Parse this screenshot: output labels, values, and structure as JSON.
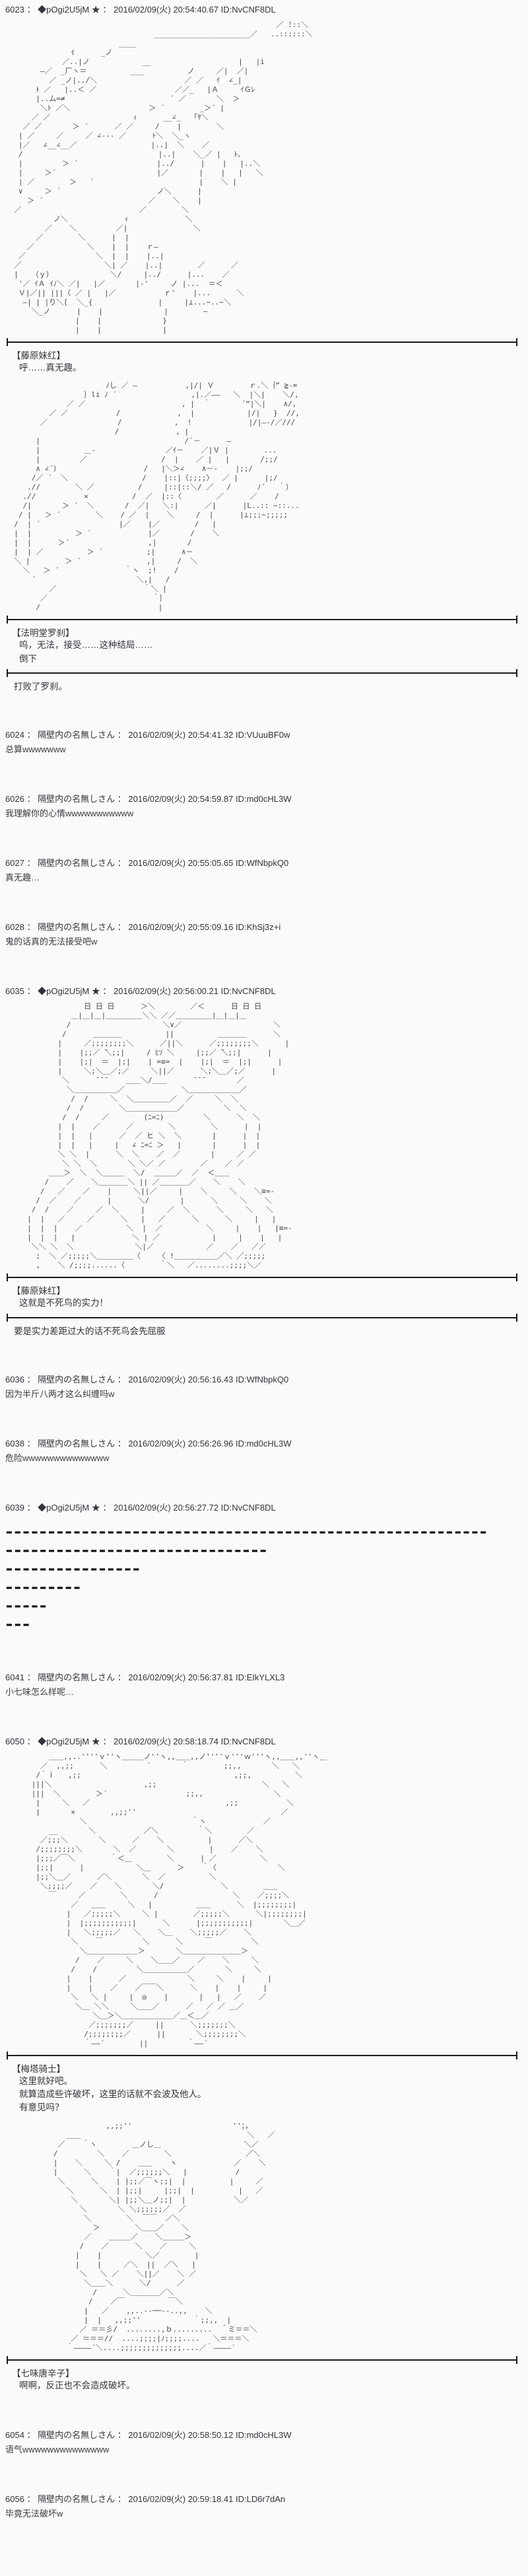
{
  "page": {
    "background": "#fafafa",
    "text_color": "#3a3a42",
    "divider_color": "#1a1a1a"
  },
  "posts": [
    {
      "header": "6023 ： ◆pOgi2U5jM ★ ： 2016/02/09(火) 20:54:40.67 ID:NvCNF8DL",
      "aa1": [
        "                                                              ／ ̄:::＼",
        "                                  ______________________／   ..::::::＼",
        "                          ____",
        "               ｲ      _ノ",
        "             ／..|ノ            __                    |   |i",
        "        ―／  _厂ヽ＝          ___          ノ     ／|  ／|",
        "          ／ _ノ|../＼                    ／ ／   ｲ  ∠_|",
        "       ﾄ ／   |..＜ ／                  ／／_   |Ａ     ｲＧﾚ",
        "       |..ム=≠                        ´ ／       ＼  ＞",
        "        ＼ﾄ ／＼                  ＞ ´        _＞´ |",
        "      ／ ／                   ｨ      __∠_   ｢ﾔ＼",
        "    ／ ／       ＞ ´      ／ ／     /    |        ＼",
        "   | ／     ／     ／ ∠--- ／      ﾄ＼  ＼_ヽ",
        "   |／   ∠__∠__／                 |..|  ＼    ／",
        "   /                               |..|    ＼_／ |   ﾄ、",
        "   |         ＞ ´                  |../      |    |   |..＼",
        "   |     ＞´                       |／       |    |   |   ＼",
        "   | ／        ＞   ´                        |    ＼ |",
        "   ∨     ＞ ´                      ノ＼      |",
        "     ＞ ´                        ／    ＼    |",
        "  ／                           ／        ＼",
        "           ノ＼             ｨ             ＼",
        "         ／    ＼         ／|               ＼",
        "       ／        ＼      |  |",
        "     ／            ＼    |  |    ｒ―",
        "   ／                ＼  |  |    |..|",
        "  ／                   ＼| ／    |..|        ／      ／",
        "  |   （ｙ）             ＼/     |../      |...    ／",
        "   '／ ｲＡ ｲﾉ＼ ／|   |／       |-'     ノ |...  ＝＜",
        "   Ｖ|／|| |||〈 ／ |   |／           ｒ'    |...      ＼",
        "    ―| | |り＼[  ＼_{               |     |⊥...~..~＼",
        "      ＼_ノ      |    |              |        ~",
        "                |    |              }",
        "                |    |              |"
      ],
      "speech1": {
        "speaker": "【藤原妹红】",
        "lines": [
          "呼……真无趣。"
        ]
      },
      "aa2": [
        "                       ﾉし ／ ―           ,|/| Ｖ        ｒ.＼｛” ≧-=",
        "                  ｝li ﾉ ´                 ,|.／――   ＼  |＼|    ＼/,",
        "              ／ ／                      , |  ｀       ´”|＼|    ∧/,",
        "          ／ ／           /             ,  |            |/|   }  //,",
        "        ／                /            ,  !             |/|―-/／///",
        "                         /             , |",
        "       |                                 /´－      ―",
        "       |          ＿-                ／ｲ－    ／|Ｖ |        ...",
        "       |         ／                 /  |    ／ |   |       /;;/",
        "       ∧ ∠´）                   /   |＼＞∠    ∧－-    |;;/",
        "      /／ ´  ＼                 /    |::|〈;;;;〉  ／ |      |;/",
        "     .//        ＼ ／          /     |::|::＼/ ／   /      ﾉ´   ｀）",
        "    .//           ×          /  ／  |::〈        ／      ／    /",
        "    /|       ＞ ´  ＼       /  ／|   ＼:|      ／|      |L..:: ~::...",
        "   / |   ＞ ´        ＼    / ／  |    ＼     /  |      |⊥;;;~;;;;;",
        "  /  | ´                  |／    |／        /   |",
        "  |  |          ＞ ´             |／       /    ＼",
        "  |  |      ＞´                  ,|       /",
        "  |  | ／          ＞ ´          ;|      ∧－",
        "  ＼ |        ＞ ´               ,|     /  ＼",
        "    ＼   ＞ ´               ｀ヽ  ;!    /",
        "      ´                       ＼,|   /",
        "          ／                    ｀＼ |",
        "        ／                        ｀｝",
        "       /                           |"
      ],
      "speech2": {
        "speaker": "【法明堂罗刹】",
        "lines": [
          "呜，无法，接受……这种结局……",
          "倒下"
        ]
      },
      "narration": "打败了罗刹。"
    },
    {
      "header": "6024 ： 隔壁内の名無しさん ： 2016/02/09(火) 20:54:41.32 ID:VUuuBF0w",
      "body": "总算wwwwwww"
    },
    {
      "header": "6026 ： 隔壁内の名無しさん ： 2016/02/09(火) 20:54:59.87 ID:md0cHL3W",
      "body": "我理解你的心情wwwwwwwwwww"
    },
    {
      "header": "6027 ： 隔壁内の名無しさん ： 2016/02/09(火) 20:55:05.65 ID:WfNbpkQ0",
      "body": "真无趣…"
    },
    {
      "header": "6028 ： 隔壁内の名無しさん ： 2016/02/09(火) 20:55:09.16 ID:KhSj3z+i",
      "body": "鬼的话真的无法接受吧w"
    },
    {
      "header": "6035 ： ◆pOgi2U5jM ★ ： 2016/02/09(火) 20:56:00.21 ID:NvCNF8DL",
      "aa": [
        "                  日 日 日      ＞＼        ／＜      日 日 日",
        "               ＿|＿|＿|＿＿＿＿＿＼＼ ／／＿＿＿＿＿|＿|＿|＿",
        "              /                     ＼∨／                     ＼",
        "             /      ＿＿＿＿          ||          ＿＿＿＿      ＼",
        "            |     ／;;;;;;;;＼      ／||＼      ／;;;;;;;;＼      |",
        "            |    |;;／ ̄＼;;|     / ﾋｿ ＼     |;;／ ̄＼;;|      |",
        "            |    |;|  ＝  |;|    | =≡=  |    |;|  ＝  |;|      |",
        "            |     ＼;＼＿／;／     ＼||／      ＼;＼＿／;／      |",
        "             ＼      ̄ ̄ ̄     ＿＿＼/＿＿      ̄ ̄ ̄        ／",
        "              ＼＿＿＿＿＿＿／             ＼＿＿＿＿＿＿＿／",
        "               /  /     ＼  ＼＿＿＿＿＿／  ／     ＼  ＼",
        "              /  /        ＼＿＿＿＿＿＿＿／         ＼  ＼",
        "             /  /     ／        (ﾆ=ﾆ)         ＼      ＼  ＼",
        "            |  |    ／      ／        ＼        ＼      |  |",
        "            |  |   |      ／  ／ ヒ ＼  ＼       |      |  |",
        "            |  |   |     |   ∠ ﾆ=ﾆ ＞   |       |      |  |",
        "            ＼ ＼  |      ＼  ＼    ／  ／       |     ／ ／",
        "             ＼ ＼  ＼       ＼ ＼／ ／        ／    ／ ／",
        "          ＿＿＞  ＼  ＼＿＿＿  ＼/  ＿＿＿／  ／  ＜＿＿",
        "         /    ／    ＼＿＿＿＿＼ || ／＿＿＿＿／    ＼    ＼",
        "        /   ／    ／    |     ＼||／     |    ＼     ＼    ＼≡=-",
        "       /  ／    ／      |      ＼/       |      ＼     ＼    ＼",
        "      /  /    ／     ／  ＼     |     ／  ＼      ＼     ＼   ＼",
        "     |  |   ／     ／      ＼   |   ／      ＼      ＼     |   |",
        "     |  |  |    ／          ＼  |  ／          ＼     |    |   |≡=-",
        "     |  |  |   |             ＼ | ／            |     |    |   |",
        "      ＼＼ ＼  ＼              ＼|／            ／    ／   ／／",
        "       ;  ＼ ／;;;;;＼＿＿＿＿＿〈    〈 !＿＿＿＿＿＿／＼ ／;;;;;",
        "       ,    ＼ /;;;;......〈        ｀＼   ／........;;;;＼／"
      ],
      "speech1": {
        "speaker": "【藤原妹红】",
        "lines": [
          "这就是不死鸟的实力！"
        ]
      },
      "narration": "要是实力差距过大的话不死鸟会先屈服"
    },
    {
      "header": "6036 ： 隔壁内の名無しさん ： 2016/02/09(火) 20:56:16.43 ID:WfNbpkQ0",
      "body": "因为半斤八两才这么纠缠吗w"
    },
    {
      "header": "6038 ： 隔壁内の名無しさん ： 2016/02/09(火) 20:56:26.96 ID:md0cHL3W",
      "body": "危险wwwwwwwwwwwwww"
    },
    {
      "header": "6039 ： ◆pOgi2U5jM ★ ： 2016/02/09(火) 20:56:27.72 ID:NvCNF8DL",
      "impact_lines": [
        "━━━━━━━━━━━━━━━━━━━━━━━━━━━━━━━━━━━━━━━━━━━━━━━━━━━━━━━━━",
        "━━━━━━━━━━━━━━━━━━━━━━━━━━━━━━━",
        "━━━━━━━━━━━━━━━━",
        "━━━━━━━━━",
        "━━━━━",
        "━━━"
      ]
    },
    {
      "header": "6041 ： 隔壁内の名無しさん ： 2016/02/09(火) 20:56:37.81 ID:EIkYLXL3",
      "body": "小七味怎么样呢…"
    },
    {
      "header": "6050 ： ◆pOgi2U5jM ★ ： 2016/02/09(火) 20:58:18.74 ID:NvCNF8DL",
      "aa1": [
        "          ＿＿,,..''''ｖ''ヽ＿＿＿ノ''ヽ,,＿＿,,ノ''''ｖ'''ｗ'''ヽ,,＿＿,,''ヽ＿",
        "        ／  ,,;;      ＼         ´       ｀        ;;,,       ＼   ＼",
        "       /｀ｉ   ,;;                                   ,;;,          ＼",
        "      |||＼                     ,;;                        ＼   ＼",
        "      |||  ＼        ＞´                  ;;,,                ＼",
        "       |     ＼   ／                               ,;;           ＼",
        "       |       ×        ,,;;''                                 ／",
        "                 ＼                        ｀ヽ             ／",
        "          __       ＼           ／＼         ｀＼        ／",
        "        ／;;;＼       ＼      ／    ＼          |      ／＼",
        "       /;;;;;;;;＼       ＼  ／       ＼        |    ／    ＼",
        "       |;;;／￣＼        ｀＜＿        ＼      | ／          ＼",
        "       |;;|      |            ＼＿      ＞    ｀〈              ＼",
        "       |;;＼＿／      ／＼       ＼  ／          ＼",
        "        ＼;;;;／    ／    ＼       ＼/             ＼        ＿＿",
        "          ￣     ／        ＼      /                 ＼    ／;;;;＼",
        "               ／   ＿＿     ＼   |          ＿＿      ＼  |;;;;;;;;|",
        "              |   ／;;;;;＼     ＼ |        ／;;;;;＼      ＼|;;;;;;;;|",
        "              |  |;;;;;;;;;;;|      ＼      |;;;;;;;;;;;|       ＼＿／",
        "              |   ＼;;;;;／   ＼    ＼＿    ＼;;;;;／    ＼",
        "               ＼    ￣         ＼      ＼     ￣         ＼",
        "                 ＼＿＿＿＿＿＿＿＞       ＼＿＿＿＿＿＿＿＿＞",
        "                /    ／     ＼    ＼＿＿／    ／    ＼     ＼",
        "               /    /         ＼＿＿＿＿＿＿／       ＼     ＼",
        "              |    |      ／              ＼     ＼    |     |",
        "              |    |    ／    ／￣￣＼      ＼    |    |     |",
        "               ＼   ＼ |     |  ◎    |       |   |   ／    ／",
        "                ＼＿ ＼＼     ＼＿＿／      ／   ／ ／ ＿／",
        "                    ＼＿＞＼＿＿＿＿＿＿＿／＿＜＿／",
        "                   ／;;;;;;;／     ||      ＼;;;;;;;＼",
        "                  /;;;;;;;;／      ||       ＼;;;;;;;;＼",
        "                  ｀――´        ||         ｀――´"
      ],
      "speech1": {
        "speaker": "【梅塔骑士】",
        "lines": [
          "这里就好吧。",
          "就算造成些许破坏，这里的话就不会波及他人。",
          "有意见吗？"
        ]
      },
      "aa2": [
        "                       ,,;;''                       ''；，",
        "              ＿＿                                      ＼   ／",
        "            ／    ｀ヽ        ＿ノし＿                   ＼／",
        "           /         ＼    ／        ＼                 ／＼",
        "           |    ＼     ＼ /    ＿＿    ヽ             ／    ＼",
        "           |      ＼    ｀|  ／;;;;;;＼   |           /",
        "            ＼      ＼    | |;;／￣ヽ;;|  |          |     ／",
        "              ＼      ＼  | |;;|     |;;|  |          |   ／",
        "               ＼       ＼| |;;＼＿ノ;;|  |           ＼／",
        "                 ＼       ＼ ＼;;;;;;／  ／",
        "                  ＼        ＼  ￣￣  ／＼",
        "                    ＞        ＼＿＿／    ＼",
        "                  ／    ＿＿＿／    ＼＿＿＿＞",
        "                 /    ／      ＼    ／     ＼",
        "                |    |          ＼／        |",
        "                |    |     ／＼  ||  ／＼   |",
        "                 ＼   ＼ ／    ＼||／    ＼ ／",
        "                  ＼＿＿＼      ＼/      ／",
        "                    /      ＼＿＿＿＿／＼",
        "                   /    ／￣          ￣＼",
        "                  |   ／    ,,..--──--..,,    ＼",
        "                  |  |   ,,;;''            ｀;;,,  |",
        "                 ／ ＝＝彡/  ........,ｂ.........  ＾ミ＝＝＼",
        "               ／ ＝＝＝//  ....;;;;|ﾉ;;;;....   ＼＝＝＝＼",
        "              ｀――――´＼....;;;;;;;;;;;;;;....／｀――――´"
      ],
      "speech2": {
        "speaker": "【七味唐辛子】",
        "lines": [
          "啊啊，反正也不会造成破坏。"
        ]
      }
    },
    {
      "header": "6054 ： 隔壁内の名無しさん ： 2016/02/09(火) 20:58:50.12 ID:md0cHL3W",
      "body": "语气wwwwwwwwwwwwww"
    },
    {
      "header": "6056 ： 隔壁内の名無しさん ： 2016/02/09(火) 20:59:18.41 ID:LD6r7dAn",
      "body": "毕竟无法破坏w"
    }
  ]
}
